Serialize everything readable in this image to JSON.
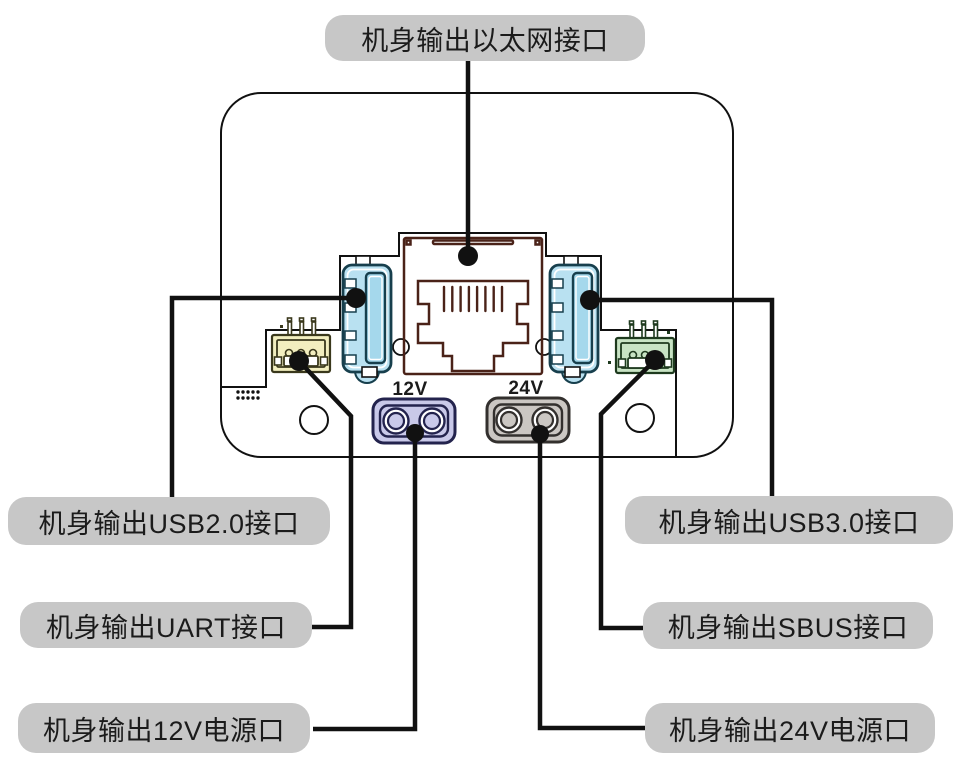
{
  "diagram": {
    "callouts": {
      "ethernet": {
        "label": "机身输出以太网接口"
      },
      "usb2": {
        "label": "机身输出USB2.0接口"
      },
      "uart": {
        "label": "机身输出UART接口"
      },
      "power12v": {
        "label": "机身输出12V电源口"
      },
      "usb3": {
        "label": "机身输出USB3.0接口"
      },
      "sbus": {
        "label": "机身输出SBUS接口"
      },
      "power24v": {
        "label": "机身输出24V电源口"
      }
    },
    "port_markings": {
      "v12": "12V",
      "v24": "24V"
    },
    "colors": {
      "body_fill": "#ffffff",
      "outline": "#111111",
      "label_bg": "#c7c7c7",
      "label_text": "#1b1b1b",
      "ethernet_fill": "#f9cbbb",
      "ethernet_stroke": "#4a2218",
      "usb_fill": "#b9e1f1",
      "usb_tongue_fill": "#a5d8ec",
      "usb_stroke": "#173f4d",
      "uart_fill": "#f2eebf",
      "uart_stroke": "#3a381c",
      "sbus_fill": "#c8e3c4",
      "sbus_stroke": "#1e3a1e",
      "v12_fill": "#c9c9e9",
      "v12_stroke": "#23234d",
      "v24_fill": "#cbc7c3",
      "v24_stroke": "#33302e"
    }
  }
}
